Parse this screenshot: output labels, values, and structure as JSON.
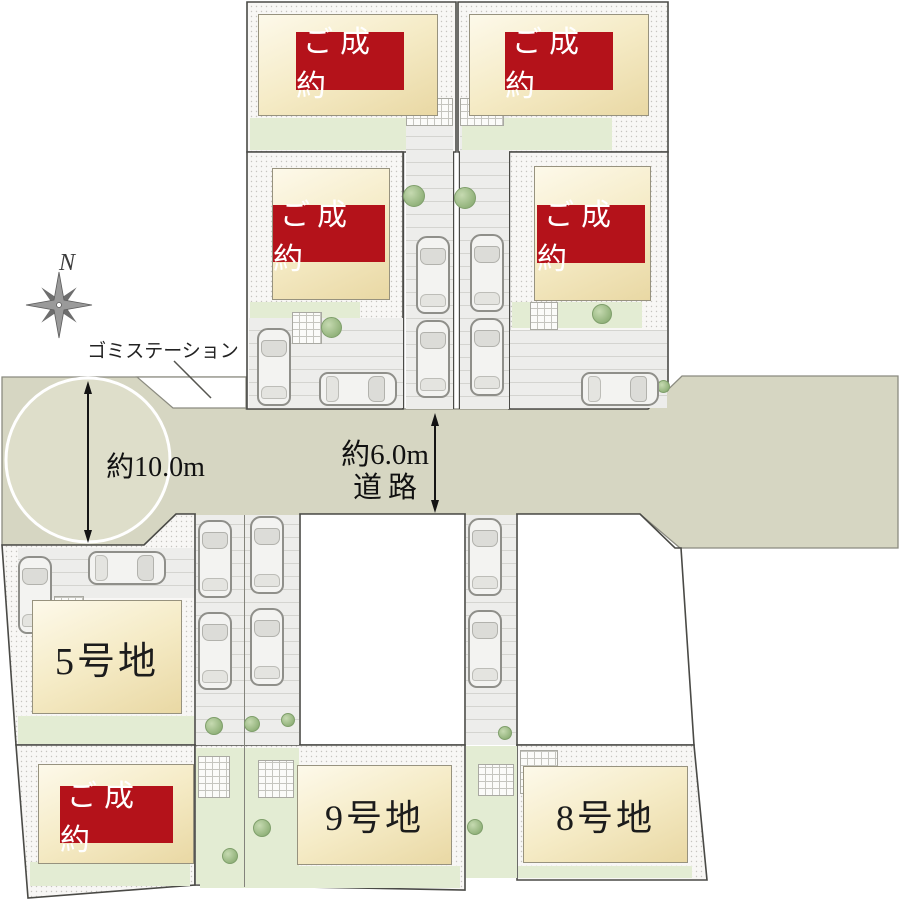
{
  "labels": {
    "sold": "ご成約",
    "lot5": "5号地",
    "lot9": "9号地",
    "lot8": "8号地",
    "dim10": "約10.0m",
    "dim6": "約6.0m",
    "road": "道路",
    "garbage": "ゴミステーション",
    "north": "N"
  },
  "colors": {
    "road": "#d6d6c2",
    "circle": "#dedeca",
    "sold_bg": "#b4121a",
    "sold_text": "#ffffff",
    "house_light": "#fdf9ea",
    "house_dark": "#e9d8a4",
    "green": "#e3ecd3",
    "lot_border": "#4a4a46",
    "pavement": "#ededeb",
    "pavement_line": "#d4d4d0",
    "car_body": "#f3f3f1",
    "car_line": "#8f8f8a",
    "text": "#1c1c1c"
  }
}
